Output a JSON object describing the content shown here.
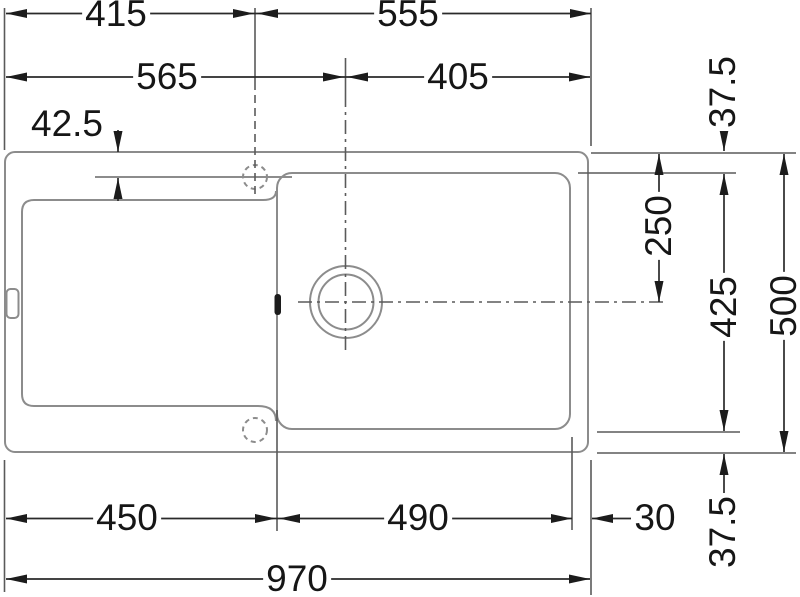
{
  "drawing": {
    "type": "sink-installation-dimension-drawing",
    "background_color": "#ffffff",
    "outline_color": "#8c8c8c",
    "dimension_color": "#1c1c1c",
    "labels": {
      "top_left_width": "415",
      "top_right_width": "555",
      "mid_left_width": "565",
      "mid_right_width": "405",
      "tap_hole_offset": "42.5",
      "top_margin": "37.5",
      "drain_center_from_top": "250",
      "basin_depth": "425",
      "overall_depth": "500",
      "bottom_margin": "37.5",
      "drainer_width": "450",
      "basin_width": "490",
      "right_margin": "30",
      "overall_width": "970"
    }
  }
}
